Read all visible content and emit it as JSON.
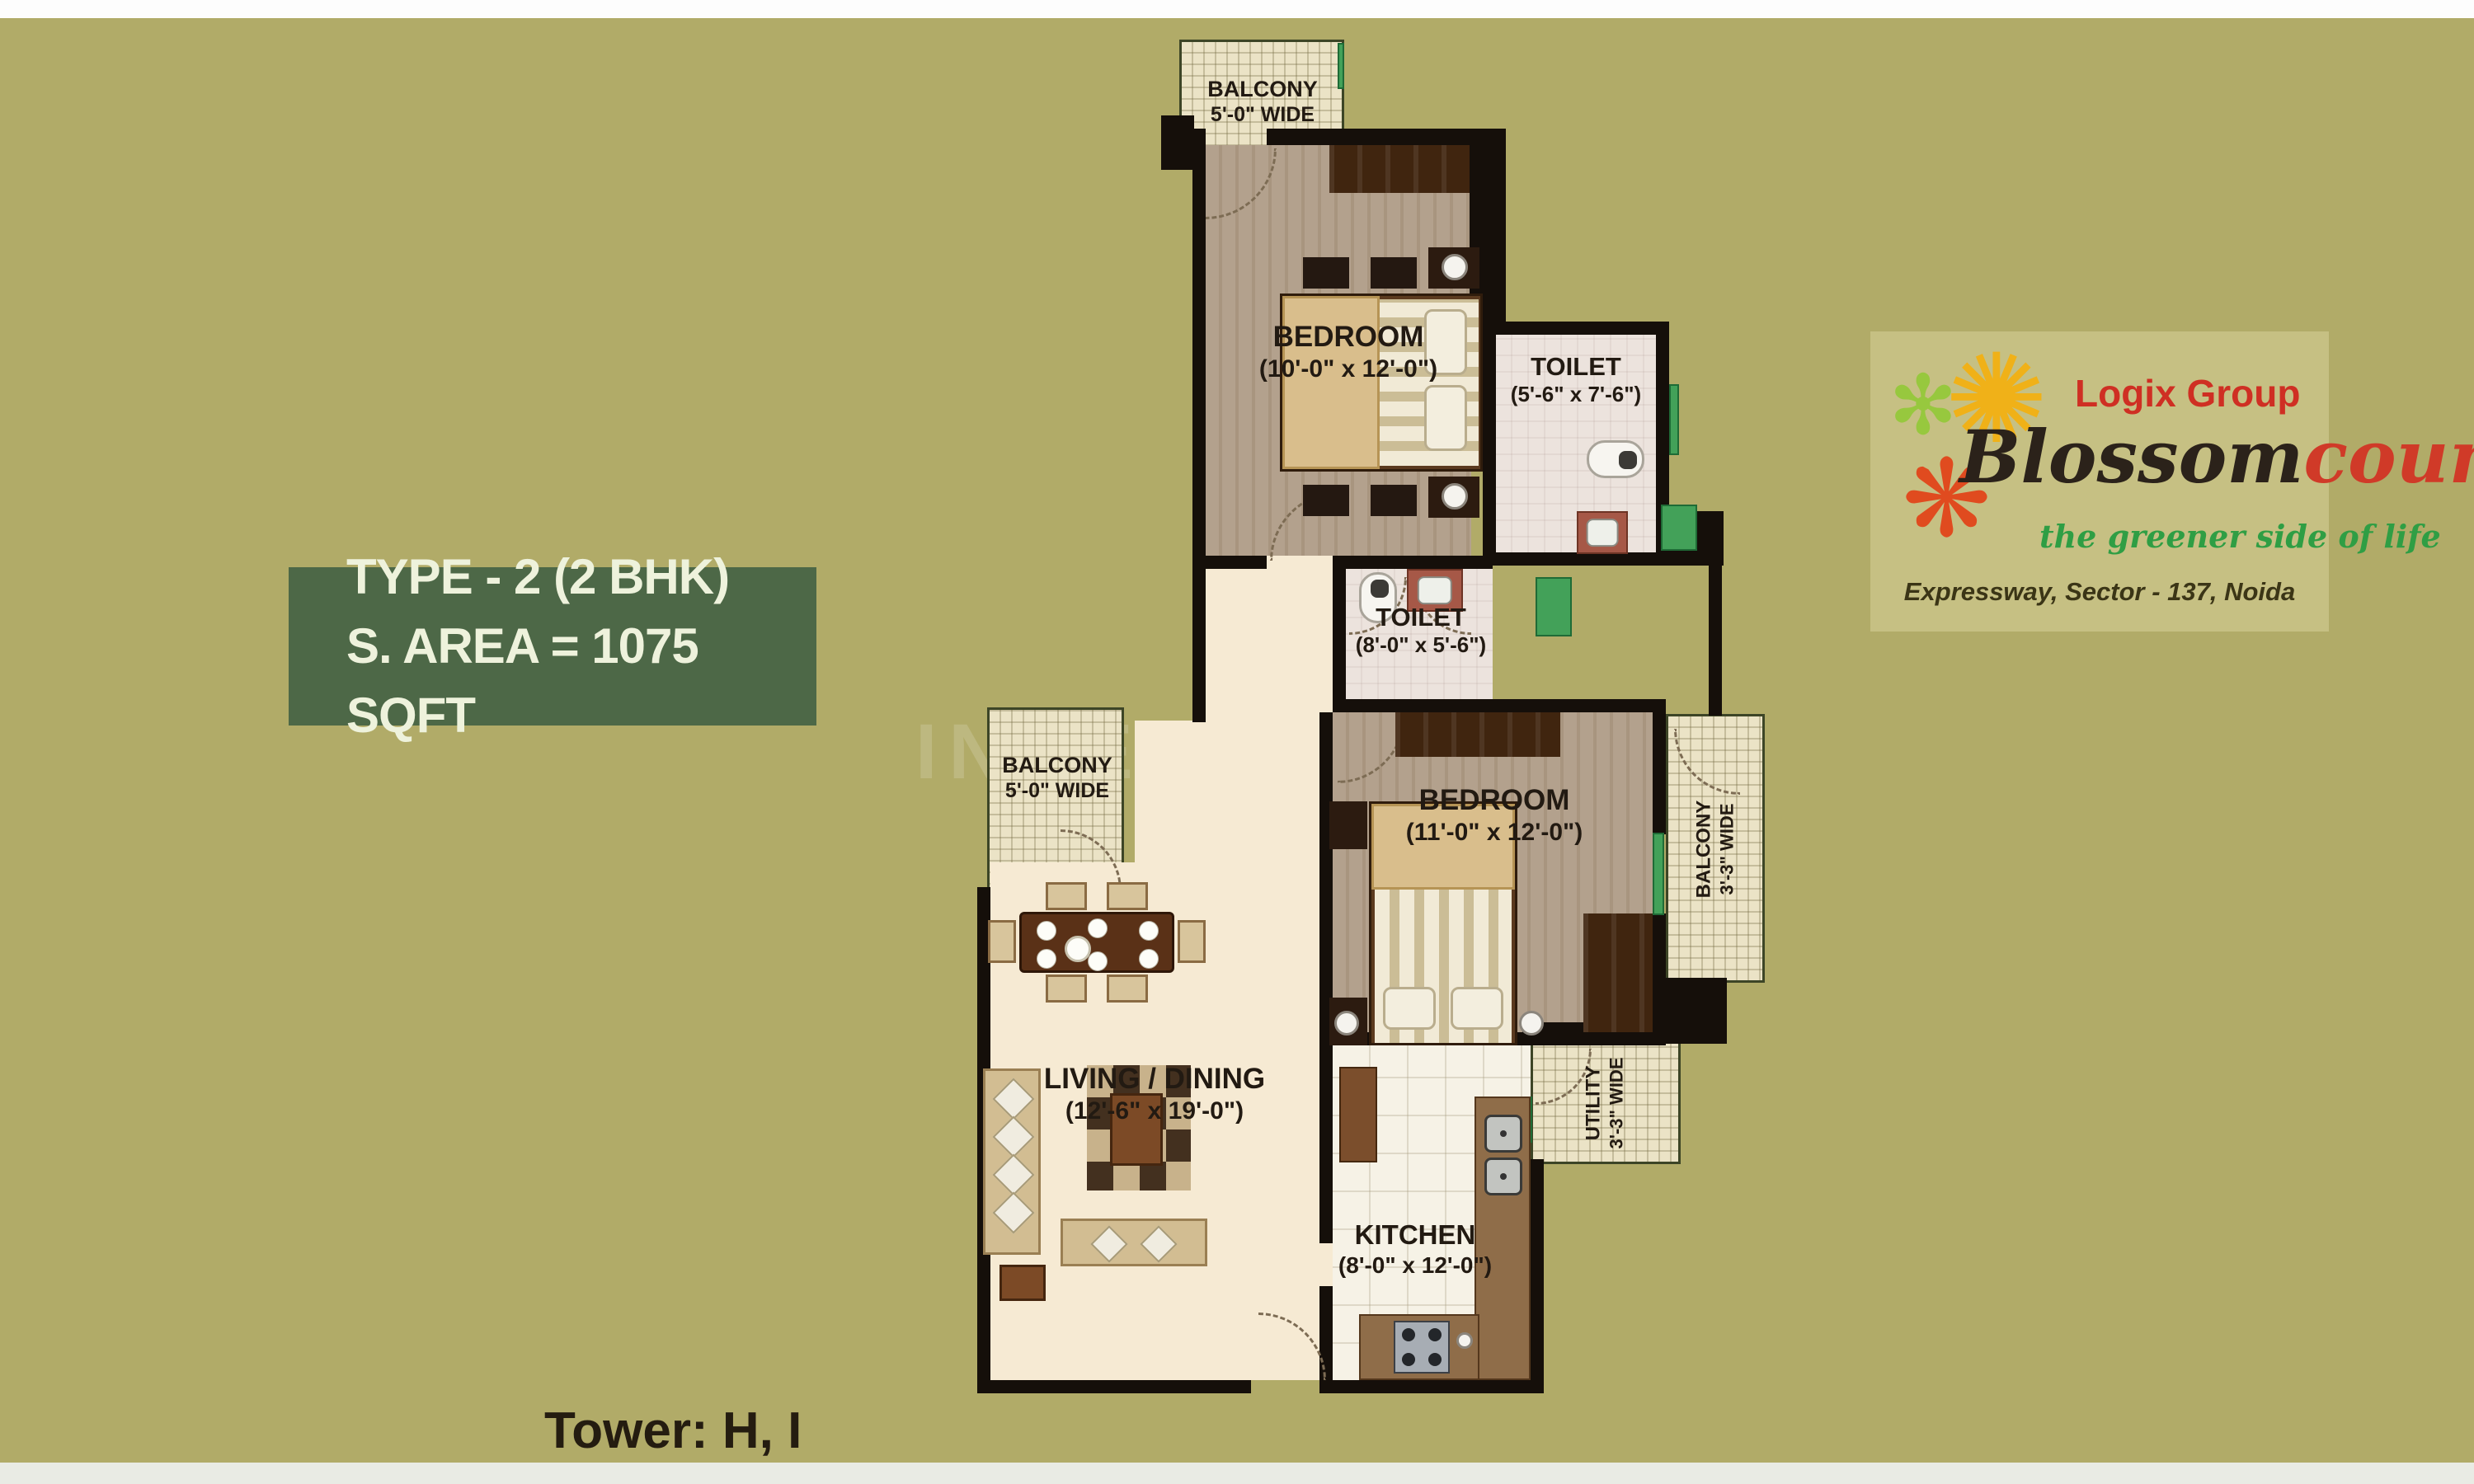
{
  "page": {
    "background": "#b1ab68",
    "watermark": "INVESTOXPERT"
  },
  "info_box": {
    "line1": "TYPE - 2 (2 BHK)",
    "line2": "S. AREA = 1075 SQFT",
    "bg_color": "#4d6847",
    "text_color": "#eef2dc"
  },
  "tower": {
    "label": "Tower: H, I"
  },
  "logo": {
    "group": "Logix Group",
    "brand_primary": "Blossom",
    "brand_secondary": "county",
    "tagline": "the greener side of life",
    "address": "Expressway, Sector - 137, Noida",
    "group_color": "#cf2f23",
    "tagline_color": "#2f9e44"
  },
  "floor_plan": {
    "wall_color": "#150f0a",
    "accent_green": "#43a159",
    "rooms": {
      "balcony_top": {
        "label": "BALCONY",
        "dims": "5'-0\" WIDE"
      },
      "bedroom1": {
        "label": "BEDROOM",
        "dims": "(10'-0\" x 12'-0\")"
      },
      "toilet1": {
        "label": "TOILET",
        "dims": "(5'-6\" x 7'-6\")"
      },
      "toilet2": {
        "label": "TOILET",
        "dims": "(8'-0\" x 5'-6\")"
      },
      "bedroom2": {
        "label": "BEDROOM",
        "dims": "(11'-0\" x 12'-0\")"
      },
      "balcony_left": {
        "label": "BALCONY",
        "dims": "5'-0\" WIDE"
      },
      "balcony_right": {
        "label": "BALCONY",
        "dims": "3'-3\" WIDE"
      },
      "living": {
        "label": "LIVING / DINING",
        "dims": "(12'-6\" x 19'-0\")"
      },
      "kitchen": {
        "label": "KITCHEN",
        "dims": "(8'-0\" x 12'-0\")"
      },
      "utility": {
        "label": "UTILITY",
        "dims": "3'-3\" WIDE"
      }
    }
  }
}
